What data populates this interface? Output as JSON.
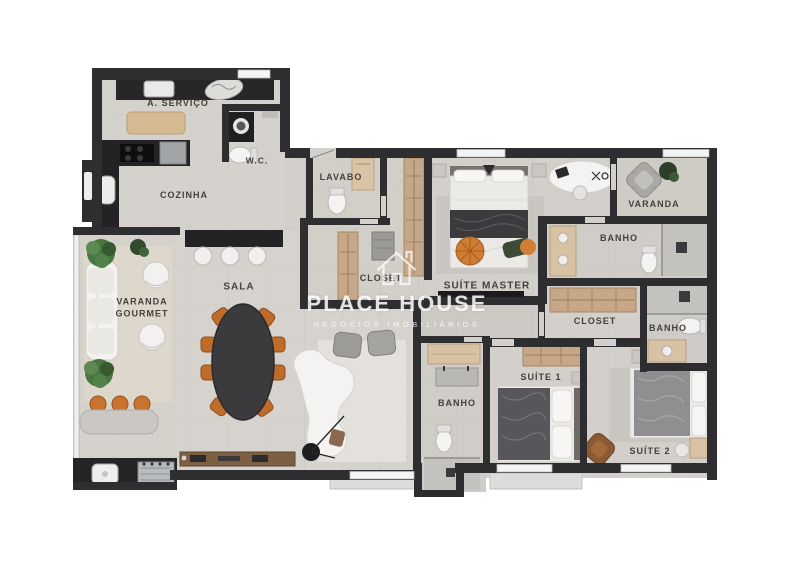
{
  "plan": {
    "type": "apartment-floor-plan",
    "rooms": {
      "servico": "A. SERVIÇO",
      "wc": "W.C.",
      "cozinha": "COZINHA",
      "lavabo": "LAVABO",
      "closet_master": "CLOSET",
      "suite_master": "SUÍTE MASTER",
      "varanda": "VARANDA",
      "banho_master": "BANHO",
      "closet_2": "CLOSET",
      "banho_suite_2": "BANHO",
      "varanda_gourmet": "VARANDA GOURMET",
      "sala": "SALA",
      "banho_central": "BANHO",
      "suite_1": "SUÍTE 1",
      "suite_2": "SUÍTE 2"
    },
    "watermark": {
      "brand": "PLACE HOUSE",
      "tagline": "NEGÓCIOS IMOBILIÁRIOS"
    },
    "colors": {
      "wall": "#2e2d30",
      "floor": "#d3d0cb",
      "wood_wardrobe": "#c6a787",
      "counter_dark": "#232326",
      "accent_orange": "#c9742e",
      "plant_green": "#4c7a43",
      "table_dark": "#3b3b3e",
      "white_furniture": "#f4f3f1",
      "label_text": "#45413b",
      "watermark": "#ffffff"
    }
  }
}
